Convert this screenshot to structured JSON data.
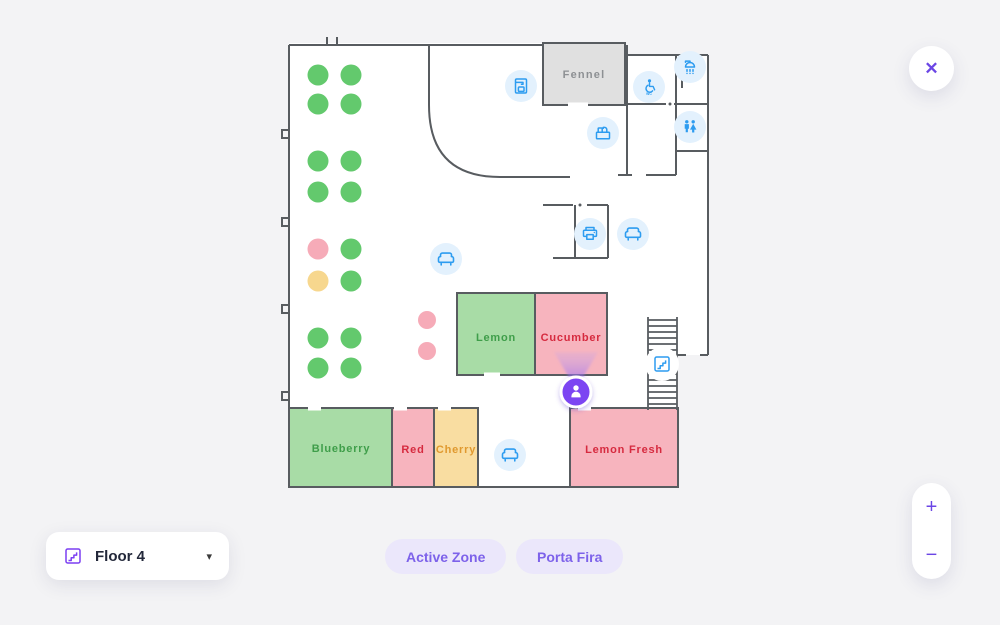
{
  "palette": {
    "accent_purple": "#6b46e5",
    "marker_purple": "#7c44f2",
    "icon_blue": "#2d9cf0",
    "icon_circle_bg": "#e3f1fd",
    "wall_gray": "#585c60",
    "page_bg": "#f3f3f5",
    "badge_bg": "#ebe7fb",
    "badge_text": "#7d62ea"
  },
  "floor_plan": {
    "rooms": [
      {
        "id": "fennel",
        "name": "Fennel",
        "fill": "#e0e0e0",
        "text_color": "#8d9093"
      },
      {
        "id": "lemon",
        "name": "Lemon",
        "fill": "#a8dca6",
        "text_color": "#3f9e4a"
      },
      {
        "id": "cucumber",
        "name": "Cucumber",
        "fill": "#f7b4be",
        "text_color": "#d62a3f"
      },
      {
        "id": "blueberry",
        "name": "Blueberry",
        "fill": "#a8dca6",
        "text_color": "#3f9e4a"
      },
      {
        "id": "red",
        "name": "Red",
        "fill": "#f7b4be",
        "text_color": "#d62a3f"
      },
      {
        "id": "cherry",
        "name": "Cherry",
        "fill": "#f9dda1",
        "text_color": "#e0992f"
      },
      {
        "id": "lemon_fresh",
        "name": "Lemon Fresh",
        "fill": "#f7b4be",
        "text_color": "#d62a3f"
      }
    ],
    "amenity_icons": [
      {
        "type": "coffee-machine-icon",
        "x": 521,
        "y": 86
      },
      {
        "type": "shower-icon",
        "x": 690,
        "y": 67
      },
      {
        "type": "accessible-wc-icon",
        "x": 649,
        "y": 87
      },
      {
        "type": "kitchen-icon",
        "x": 603,
        "y": 133
      },
      {
        "type": "wc-icon",
        "x": 690,
        "y": 127
      },
      {
        "type": "printer-icon",
        "x": 590,
        "y": 234
      },
      {
        "type": "sofa-icon",
        "x": 633,
        "y": 234
      },
      {
        "type": "sofa-icon",
        "x": 446,
        "y": 259
      },
      {
        "type": "sofa-icon",
        "x": 510,
        "y": 455
      },
      {
        "type": "stairs-icon",
        "x": 662,
        "y": 364
      }
    ],
    "dot_colors": {
      "green": "#63c96d",
      "pink": "#f6abb8",
      "yellow": "#f7d78e"
    },
    "desk_dots": [
      {
        "x": 318,
        "y": 75,
        "c": "green"
      },
      {
        "x": 351,
        "y": 75,
        "c": "green"
      },
      {
        "x": 318,
        "y": 104,
        "c": "green"
      },
      {
        "x": 351,
        "y": 104,
        "c": "green"
      },
      {
        "x": 318,
        "y": 161,
        "c": "green"
      },
      {
        "x": 351,
        "y": 161,
        "c": "green"
      },
      {
        "x": 318,
        "y": 192,
        "c": "green"
      },
      {
        "x": 351,
        "y": 192,
        "c": "green"
      },
      {
        "x": 318,
        "y": 249,
        "c": "pink"
      },
      {
        "x": 351,
        "y": 249,
        "c": "green"
      },
      {
        "x": 318,
        "y": 281,
        "c": "yellow"
      },
      {
        "x": 351,
        "y": 281,
        "c": "green"
      },
      {
        "x": 318,
        "y": 338,
        "c": "green"
      },
      {
        "x": 351,
        "y": 338,
        "c": "green"
      },
      {
        "x": 318,
        "y": 368,
        "c": "green"
      },
      {
        "x": 351,
        "y": 368,
        "c": "green"
      }
    ],
    "meeting_dots": [
      {
        "x": 427,
        "y": 320,
        "c": "pink"
      },
      {
        "x": 427,
        "y": 351,
        "c": "pink"
      }
    ],
    "user_marker": {
      "x": 576,
      "y": 392
    }
  },
  "controls": {
    "close_glyph": "✕",
    "zoom_in": "+",
    "zoom_out": "−",
    "floor_selector": {
      "label": "Floor 4",
      "caret": "▾"
    },
    "badges": [
      {
        "label": "Active Zone"
      },
      {
        "label": "Porta Fira"
      }
    ]
  }
}
